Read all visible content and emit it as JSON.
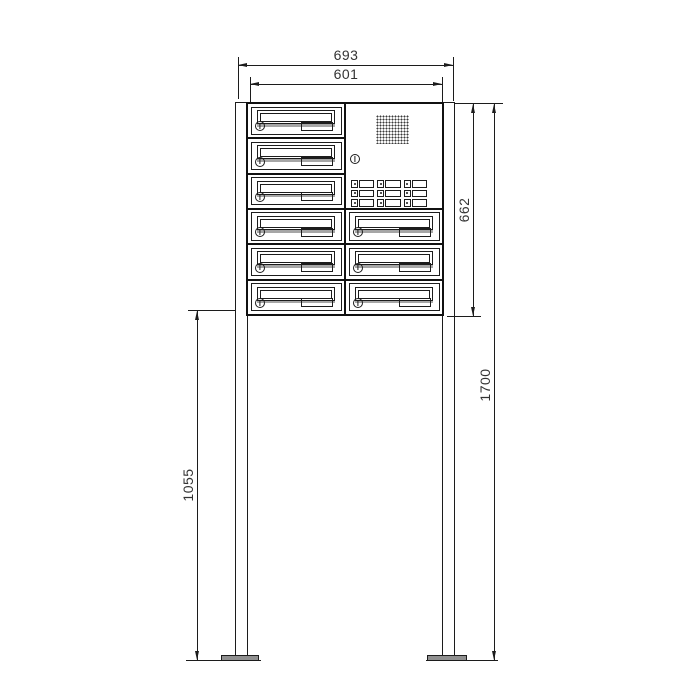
{
  "drawing": {
    "title": "free-standing letterbox unit with intercom - dimensioned technical drawing",
    "dimensions": {
      "outer_width_mm": "693",
      "unit_width_mm": "601",
      "unit_height_mm": "662",
      "total_height_mm": "1700",
      "stand_height_mm": "1055"
    },
    "unit": {
      "left_column_mailboxes": 6,
      "right_column_mailboxes": 3,
      "intercom": {
        "speaker_grille": true,
        "call_button_rows": 3,
        "call_button_cols": 3
      }
    },
    "colors": {
      "line": "#1c1c1c",
      "flap_shadow": "#a6a6a6",
      "base_plate": "#909090",
      "background": "#ffffff"
    }
  }
}
